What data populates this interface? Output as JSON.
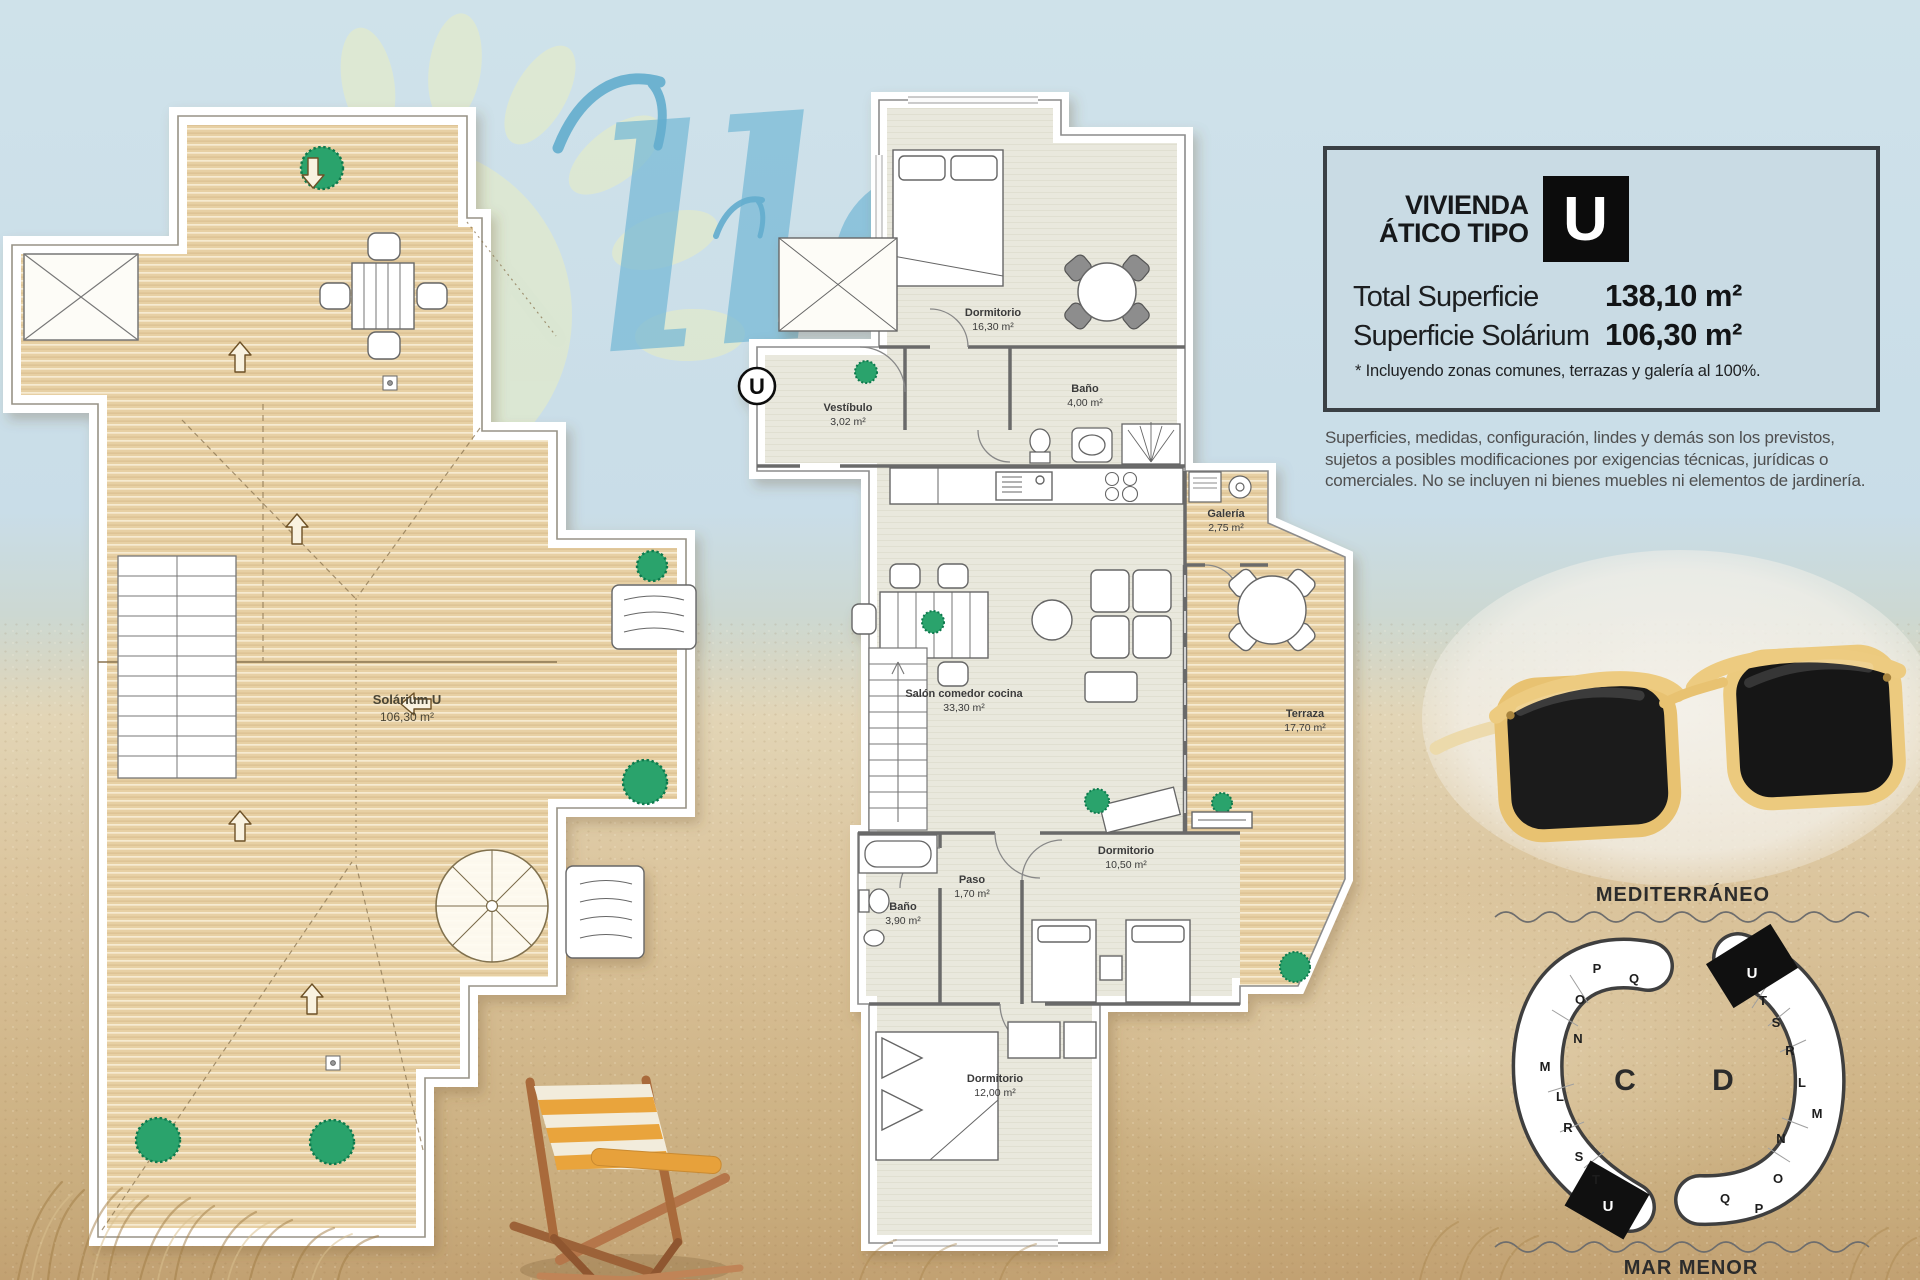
{
  "watermark": {
    "script_text": "llo"
  },
  "info_panel": {
    "title_line1": "VIVIENDA",
    "title_line2": "ÁTICO TIPO",
    "type_letter": "U",
    "rows": [
      {
        "label": "Total Superficie",
        "value": "138,10 m²"
      },
      {
        "label": "Superficie Solárium",
        "value": "106,30 m²"
      }
    ],
    "footnote": "* Incluyendo zonas comunes, terrazas y galería al 100%."
  },
  "disclaimer": "Superficies, medidas, configuración, lindes y demás son los previstos, sujetos a posibles modificaciones por exigencias técnicas, jurídicas o comerciales. No se incluyen ni bienes muebles ni elementos de jardinería.",
  "solarium_plan": {
    "room_name": "Solárium U",
    "room_area": "106,30 m²"
  },
  "main_plan": {
    "unit_marker": "U",
    "rooms": [
      {
        "name": "Dormitorio",
        "area": "16,30 m²"
      },
      {
        "name": "Baño",
        "area": "4,00 m²"
      },
      {
        "name": "Vestíbulo",
        "area": "3,02 m²"
      },
      {
        "name": "Galería",
        "area": "2,75 m²"
      },
      {
        "name": "Salón comedor cocina",
        "area": "33,30 m²"
      },
      {
        "name": "Terraza",
        "area": "17,70 m²"
      },
      {
        "name": "Dormitorio",
        "area": "10,50 m²"
      },
      {
        "name": "Paso",
        "area": "1,70 m²"
      },
      {
        "name": "Baño",
        "area": "3,90 m²"
      },
      {
        "name": "Dormitorio",
        "area": "12,00 m²"
      }
    ]
  },
  "site_map": {
    "sea_top": "MEDITERRÁNEO",
    "sea_bottom": "MAR MENOR",
    "blocks": [
      {
        "label": "C",
        "highlighted_unit": "U",
        "units": [
          "P",
          "Q",
          "O",
          "N",
          "M",
          "L",
          "R",
          "S",
          "T",
          "U"
        ]
      },
      {
        "label": "D",
        "highlighted_unit": "U",
        "units": [
          "U",
          "T",
          "S",
          "R",
          "L",
          "M",
          "N",
          "O",
          "P",
          "Q"
        ]
      }
    ]
  },
  "colors": {
    "sky": "#c9dde8",
    "sand": "#d8c29c",
    "deck_wood": "#e7d0a4",
    "interior_floor": "#e9e8dd",
    "panel_bg": "#c9dbe4",
    "panel_border": "#3a4045",
    "highlight_black": "#111111",
    "bush_green": "#2aa36c",
    "watermark_blue": "#76b9d6",
    "sunglasses_yellow": "#e8c271"
  }
}
